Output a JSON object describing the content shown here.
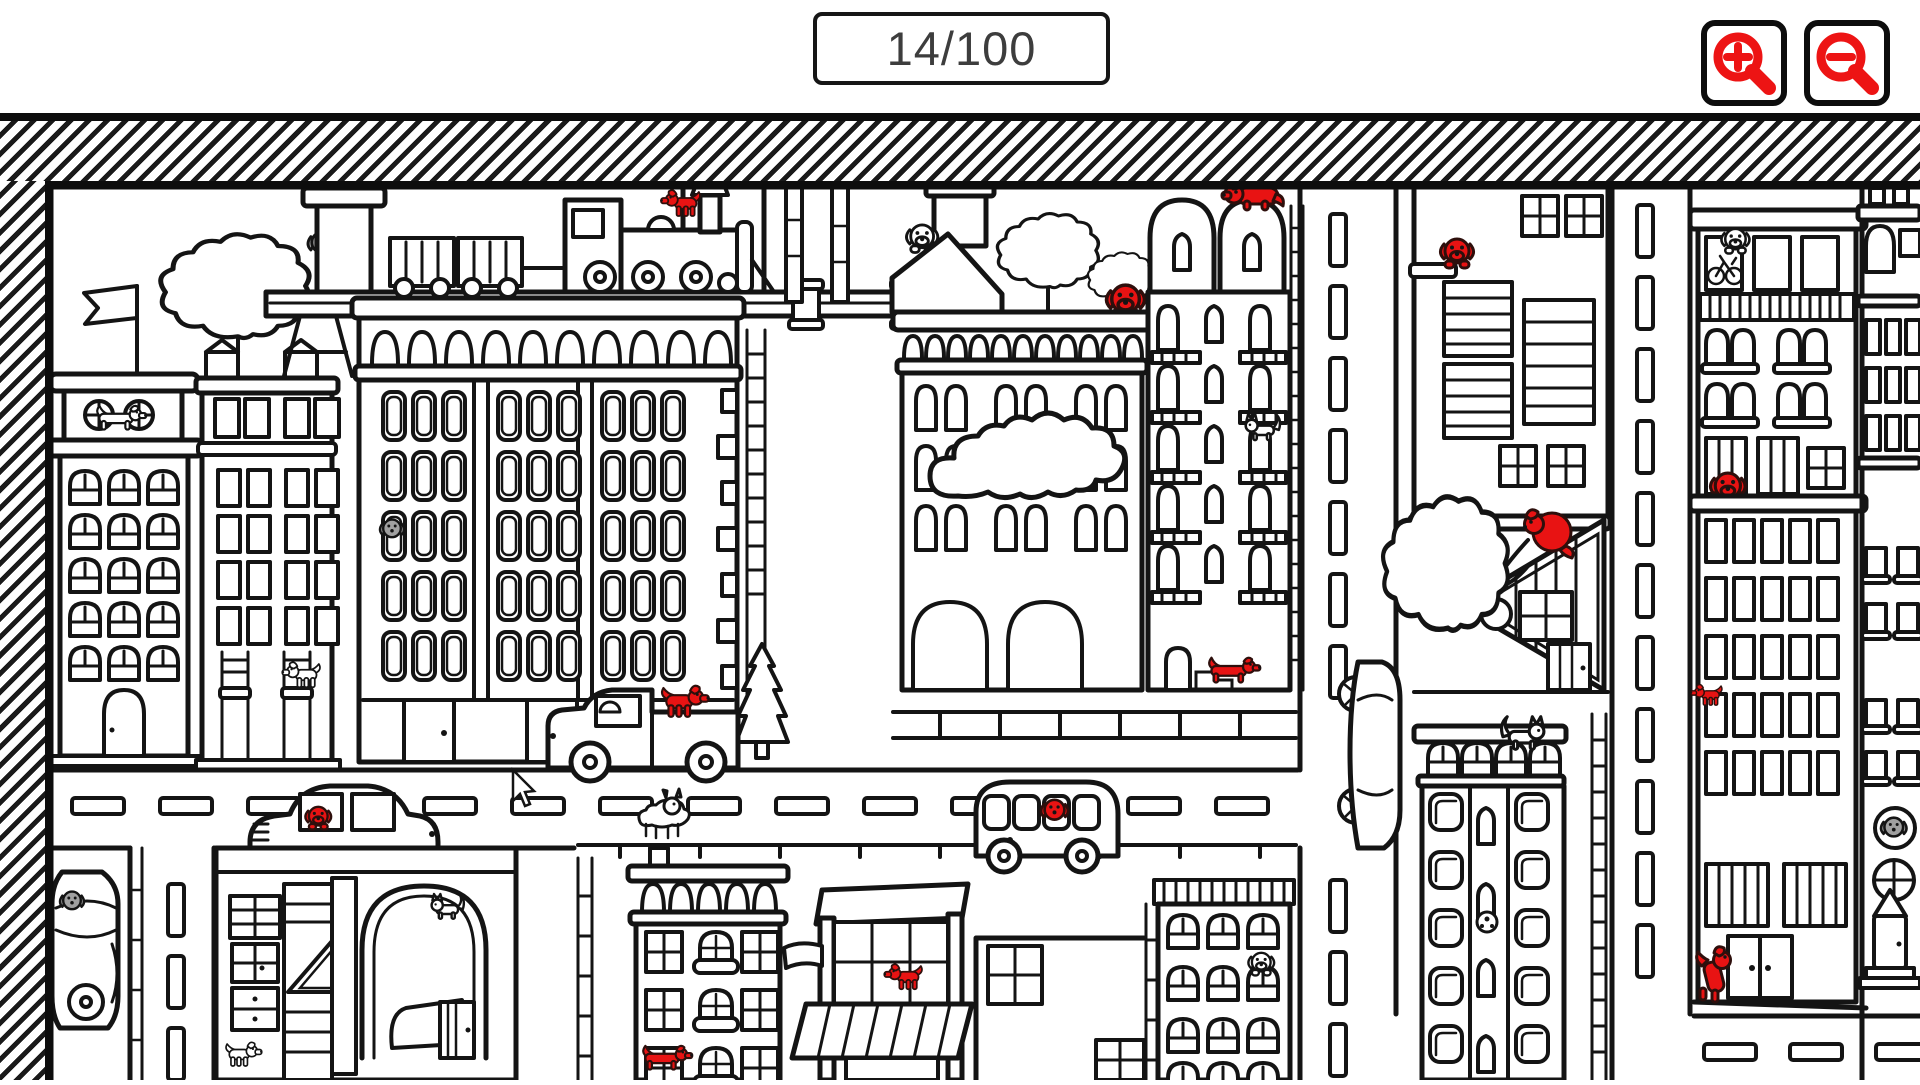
{
  "app": {
    "name": "hidden-dogs-city-puzzle"
  },
  "header": {
    "counter": {
      "text": "14/100",
      "found": 14,
      "total": 100
    },
    "zoom_in": {
      "icon": "zoom-in-magnifier-plus-icon"
    },
    "zoom_out": {
      "icon": "zoom-out-magnifier-minus-icon"
    }
  },
  "colors": {
    "red": "#e81313",
    "ink": "#141414",
    "gray": "#a0a0a0",
    "counter": "#3d3d3d",
    "paper": "#ffffff"
  },
  "scene": {
    "style": "black-and-white line-art city coloring page; found hidden dogs are colored red",
    "border": "diagonal-hatched band on top and left, thick black frame",
    "cursor": {
      "x": 513,
      "y": 772
    },
    "found_dogs": [
      {
        "id": 1,
        "location": "standing on the steam locomotive boiler",
        "x": 640,
        "y": 205
      },
      {
        "id": 2,
        "location": "head peeking over arch-building cornice by roof trees",
        "x": 1125,
        "y": 300
      },
      {
        "id": 3,
        "location": "lying on top of the right arched tower",
        "x": 1252,
        "y": 200
      },
      {
        "id": 4,
        "location": "riding in the pickup-truck bed",
        "x": 695,
        "y": 715
      },
      {
        "id": 5,
        "location": "driver window of the sedan on the main road",
        "x": 316,
        "y": 826
      },
      {
        "id": 6,
        "location": "face in the third bus window",
        "x": 1053,
        "y": 812
      },
      {
        "id": 7,
        "location": "dachshund on the steps of the balcony building",
        "x": 1240,
        "y": 672
      },
      {
        "id": 8,
        "location": "peeking over the parapet of the right tower block",
        "x": 1726,
        "y": 490
      },
      {
        "id": 9,
        "location": "clinging to the lower-left corner ledge of the right tower block",
        "x": 1706,
        "y": 698
      },
      {
        "id": 10,
        "location": "jumping at the double door of the right tower block",
        "x": 1716,
        "y": 978
      },
      {
        "id": 11,
        "location": "peeking over the ledge of the shuttered-window building",
        "x": 1455,
        "y": 256
      },
      {
        "id": 12,
        "location": "curled on a branch above the triangle gable",
        "x": 1550,
        "y": 530
      },
      {
        "id": 13,
        "location": "inside the corner-shop window",
        "x": 903,
        "y": 982
      },
      {
        "id": 14,
        "location": "dachshund in the bottom window of the arcade building",
        "x": 663,
        "y": 1060
      }
    ],
    "other_animals": [
      {
        "name": "white dachshund on tower ledge",
        "x": 122,
        "y": 420
      },
      {
        "name": "gray bear behind chimney",
        "x": 322,
        "y": 250
      },
      {
        "name": "gray dog face in big building window",
        "x": 395,
        "y": 532
      },
      {
        "name": "white dog standing on chair",
        "x": 292,
        "y": 690
      },
      {
        "name": "white dog head on gable roof",
        "x": 928,
        "y": 238
      },
      {
        "name": "white cat on balcony",
        "x": 1260,
        "y": 430
      },
      {
        "name": "white doodle goat on the road",
        "x": 658,
        "y": 818
      },
      {
        "name": "white fox-cat on bottom-right roof",
        "x": 1525,
        "y": 710
      },
      {
        "name": "white dog head in arched window",
        "x": 1252,
        "y": 965
      },
      {
        "name": "gray dog face in porthole window",
        "x": 1895,
        "y": 828
      },
      {
        "name": "white dog head in top-right window",
        "x": 1735,
        "y": 240
      },
      {
        "name": "bicycle doodle in window",
        "x": 1724,
        "y": 262
      },
      {
        "name": "soccer ball in small arch window",
        "x": 1488,
        "y": 921
      },
      {
        "name": "gray dog in parked car",
        "x": 74,
        "y": 901
      },
      {
        "name": "white cat on garage arch",
        "x": 440,
        "y": 905
      },
      {
        "name": "white dog at garage corner",
        "x": 248,
        "y": 1058
      }
    ],
    "vehicles": [
      "steam train on elevated track",
      "pickup truck",
      "sedan car",
      "rounded bus",
      "car on vertical road",
      "parked car in side strip"
    ],
    "landmarks": [
      "flag tower",
      "oak tree on roof",
      "big window-grid building",
      "cloud over arch building",
      "twin arch towers with balconies",
      "triangle-gable shed with tree",
      "corner shop with awning",
      "obelisk monument",
      "three vertical roads",
      "main road with dashed lane markings"
    ]
  }
}
